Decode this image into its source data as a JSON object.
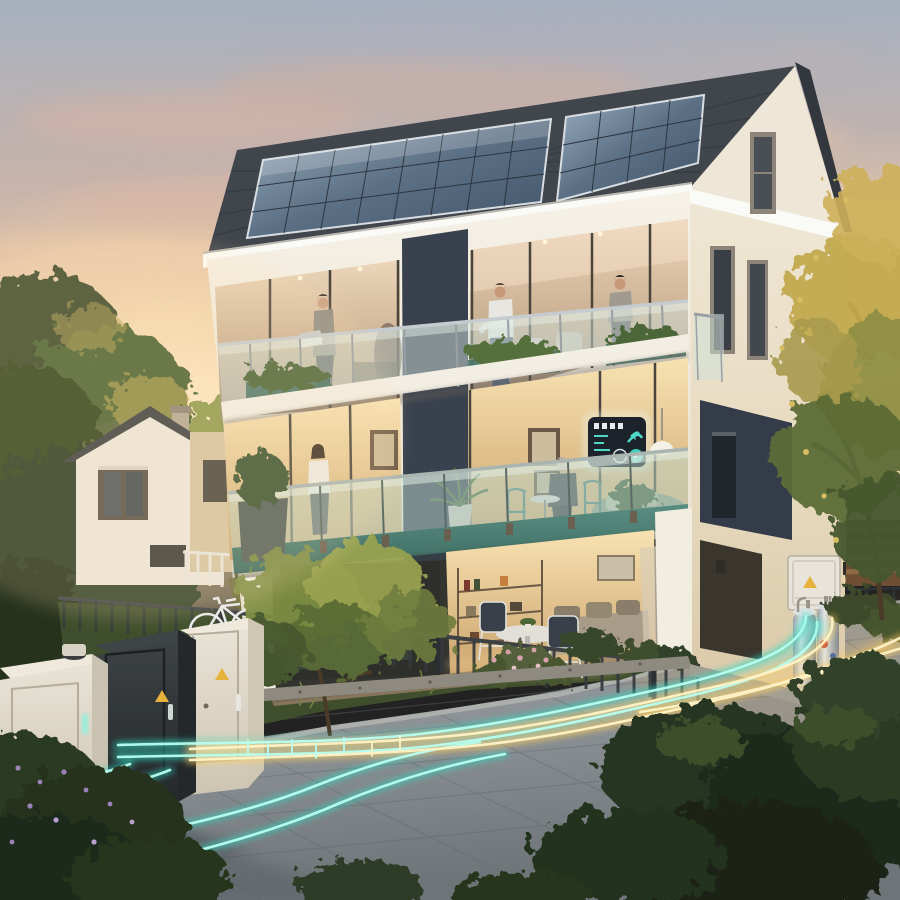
{
  "title": "Sunset photorealistic render: three-storey smart-energy apartment house with rooftop solar panels, glass balconies with residents, a glowing smart-home wall display, street-side utility cabinets and luminous energy lines running across the paved plaza",
  "colors": {
    "sky_top": "#a7b1bf",
    "sky_warm": "#f2d2a9",
    "sun_glow": "#ffe9c4",
    "cloud_pink": "#e3bfa9",
    "roof_tile": "#41464d",
    "solar_panel_dark": "#3f5268",
    "solar_panel_light": "#9db0c2",
    "fascia_white": "#fafaf6",
    "facade_front": "#f4efe5",
    "facade_side": "#e9dfc9",
    "accent_navy": "#39414f",
    "navy_panel": "#343c49",
    "balcony_teal": "#4a7a72",
    "glass_warm": "#e7cfae",
    "glass_cool": "#cfe0d8",
    "interior_warm": "#f6dca6",
    "interior_deep": "#caa36c",
    "smart_panel_dark": "#1d232b",
    "smart_panel_teal": "#4fd8c6",
    "pavement_light": "#9aa0a2",
    "pavement_dark": "#71777b",
    "joint_gray": "#60666a",
    "glow_teal": "#2fd8c2",
    "glow_teal_core": "#b9fff1",
    "glow_yellow": "#ffcf5e",
    "glow_yellow_core": "#fff4c8",
    "cabinet_cream": "#e5dfd1",
    "cabinet_cream_side": "#cfc7b4",
    "cabinet_dark": "#33383b",
    "warning_yellow": "#e6b23c",
    "metal_silver": "#cfd3d6",
    "grass_green": "#42522f",
    "foliage_dark": "#2c3a24",
    "foliage_mid": "#4c6233",
    "foliage_warm": "#9aa44e",
    "foliage_gold": "#c5ab54",
    "wood_fence": "#8a6544",
    "metal_fence": "#35393c",
    "bike_white": "#e8eaec",
    "deck_wood": "#86755c"
  },
  "scene": {
    "setting": "residential neighborhood at dusk, warm low sun from the left",
    "main_house": {
      "storeys": 3,
      "features": [
        "solar-panel-roof",
        "dark-tile-roof",
        "white-render-facade",
        "navy-accent-panels",
        "glass-balustrade-balconies",
        "teal-balcony-fascia",
        "smart-home-wall-display",
        "pendant-lamp",
        "wall-mounted-inverter-box",
        "stainless-heat-pump-tanks",
        "gable-window",
        "juliet-balcony"
      ]
    },
    "smart_display": {
      "screen_elements": [
        "indicator-bars",
        "arrow-gauge",
        "stat-lines",
        "two-circular-controls"
      ],
      "glow": "teal-white halo"
    },
    "people": [
      {
        "where": "top-balcony-left",
        "pose": "standing with laptop on railing"
      },
      {
        "where": "top-balcony-interior",
        "pose": "silhouette behind glass"
      },
      {
        "where": "top-balcony-center",
        "pose": "leaning on railing, white polo"
      },
      {
        "where": "top-balcony-corner",
        "pose": "standing, grey sweater"
      },
      {
        "where": "middle-balcony-left",
        "pose": "standing woman, white top"
      },
      {
        "where": "middle-balcony-table",
        "pose": "elderly man seated at bistro table"
      }
    ],
    "utility_cabinets": [
      {
        "color": "cream",
        "details": [
          "round-roof-vent",
          "glowing-teal-handle"
        ]
      },
      {
        "color": "dark-grey",
        "details": [
          "warning-triangle-sticker",
          "lit-handle"
        ]
      },
      {
        "color": "cream",
        "details": [
          "warning-triangle-sticker",
          "metal-handle"
        ]
      }
    ],
    "energy_lines": {
      "teal_strands": 4,
      "yellow_strands": 3,
      "extras": [
        "connector-tick-marks",
        "branch to bottom-left corner",
        "branch curling to house connection tanks",
        "branch exiting right edge"
      ]
    },
    "garden": [
      "small-ornamental-tree",
      "flowering-shrub-pink",
      "round-clipped-shrubs",
      "grasses",
      "purple-flower-bush",
      "dark-metal-slat-fence",
      "white-city-bike",
      "stone-curb",
      "gravel-strip"
    ],
    "neighborhood": [
      "white-gable-house-with-shuttered-window",
      "cream-house-sliver",
      "dark-roofs-with-chimneys",
      "backlit-trees",
      "horizontal-wood-fence"
    ]
  }
}
